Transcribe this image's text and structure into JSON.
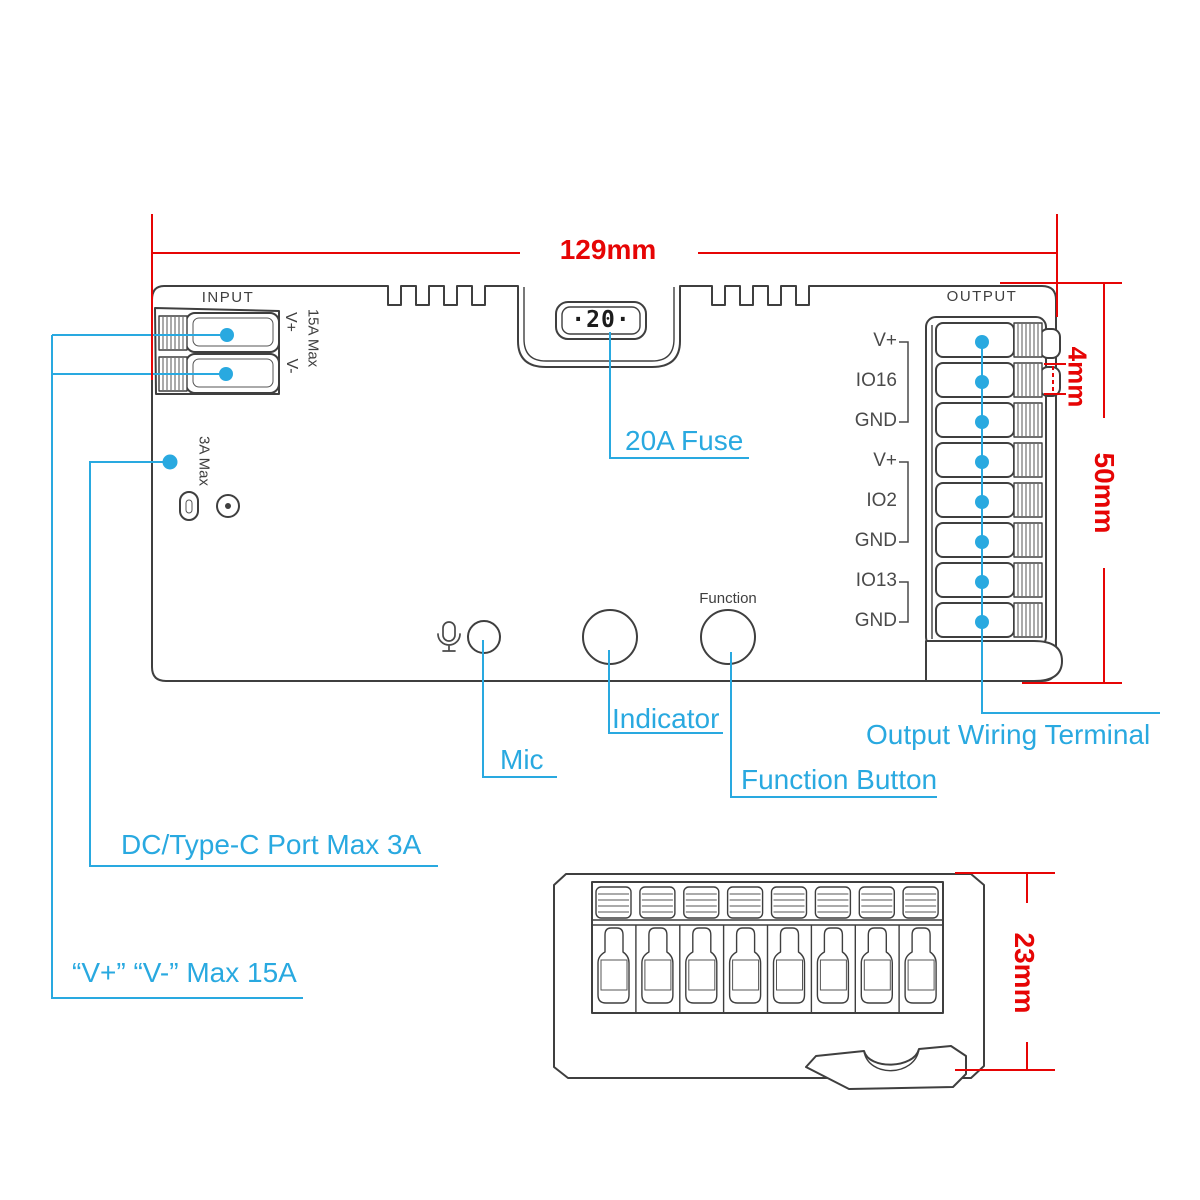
{
  "colors": {
    "red": "#e60505",
    "cyan": "#29a9e0",
    "ink": "#3f3f3f",
    "label": "#4a4a4a"
  },
  "dimensions": {
    "width": "129mm",
    "height": "50mm",
    "terminal_pitch": "4mm",
    "depth": "23mm"
  },
  "device": {
    "input_label": "INPUT",
    "output_label": "OUTPUT",
    "fuse_display": "·20·",
    "function_button_label": "Function",
    "input_terminals": {
      "vplus": "V+",
      "vminus": "V-",
      "max_current": "15A Max"
    },
    "dc_port_max": "3A Max",
    "output_pins": [
      "V+",
      "IO16",
      "GND",
      "V+",
      "IO2",
      "GND",
      "IO13",
      "GND"
    ]
  },
  "callouts": {
    "fuse": "20A Fuse",
    "mic": "Mic",
    "indicator": "Indicator",
    "function_button": "Function Button",
    "output_terminal": "Output Wiring Terminal",
    "dc_port": "DC/Type-C Port Max 3A",
    "power_input": "“V+” “V-” Max 15A"
  }
}
